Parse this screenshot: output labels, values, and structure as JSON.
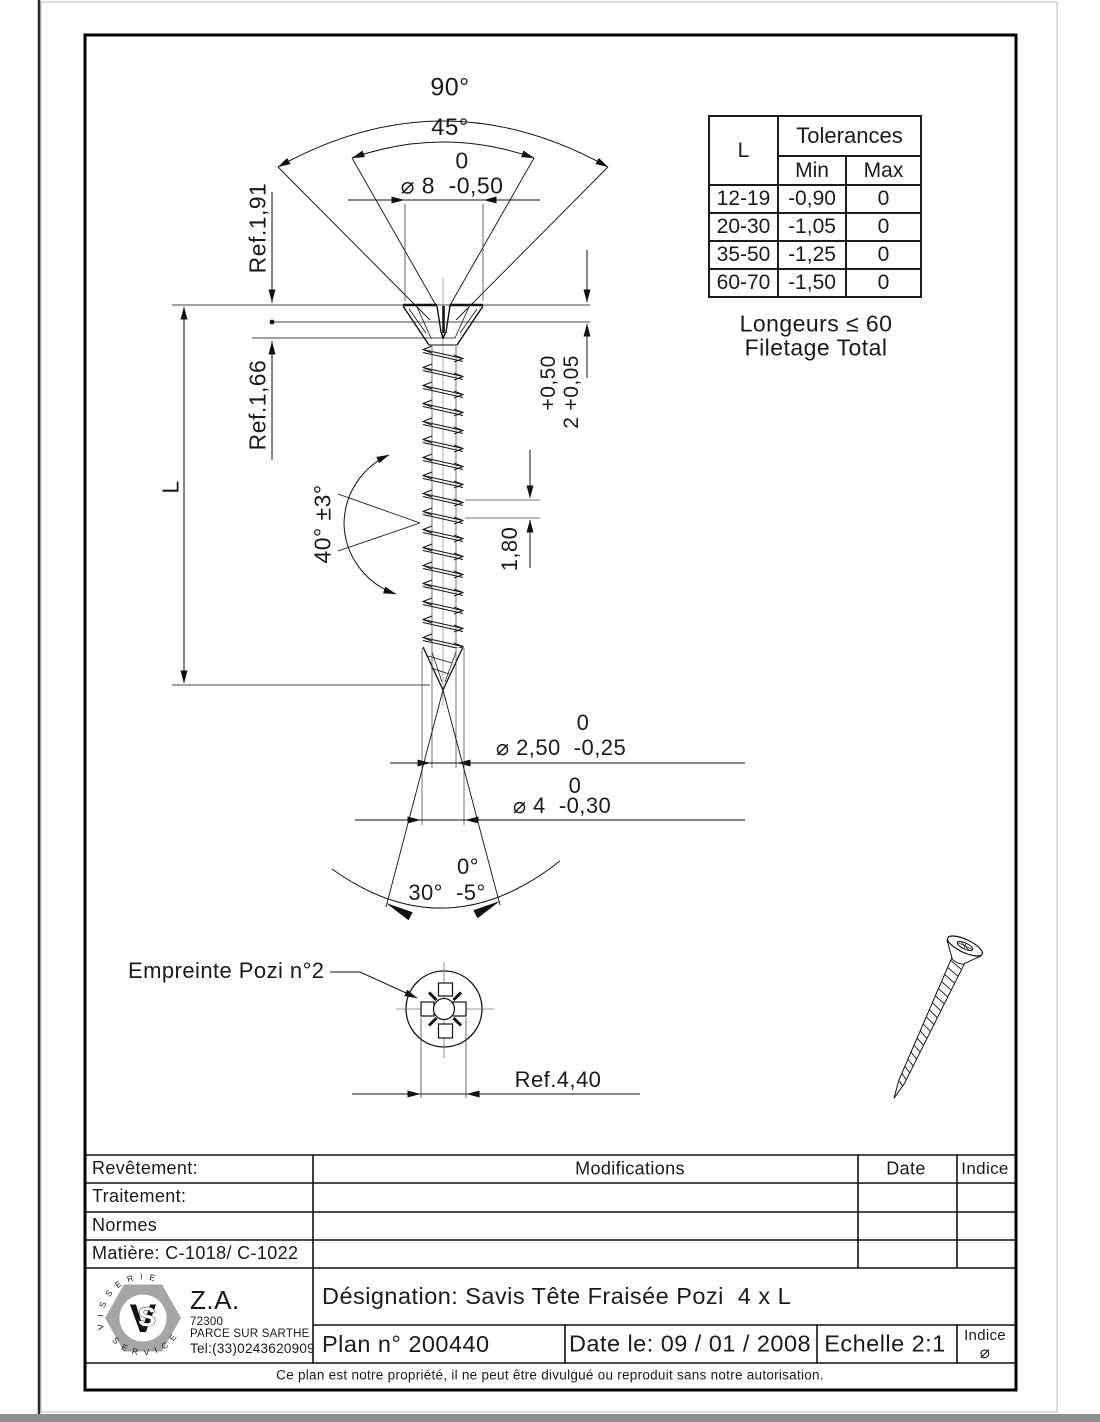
{
  "drawing": {
    "dims": {
      "angle_head_outer": "90°",
      "angle_head_inner": "45°",
      "dia_head_tol": "0",
      "dia_head": "⌀ 8  -0,50",
      "ref_head_1": "Ref.1,91",
      "ref_head_2": "Ref.1,66",
      "length": "L",
      "head_height_tol": "+0,50",
      "head_height": "2 +0,05",
      "thread_angle": "40° ±3°",
      "pitch": "1,80",
      "dia_core_tol": "0",
      "dia_core": "⌀ 2,50  -0,25",
      "dia_thread_tol": "0",
      "dia_thread": "⌀ 4  -0,30",
      "tip_angle_tol": "0°",
      "tip_angle": "30°  -5°",
      "recess_label": "Empreinte Pozi n°2",
      "recess_ref": "Ref.4,40"
    },
    "note_line1": "Longeurs ≤ 60",
    "note_line2": "Filetage Total"
  },
  "tolerances_table": {
    "col_l": "L",
    "title": "Tolerances",
    "min": "Min",
    "max": "Max",
    "rows": [
      {
        "l": "12-19",
        "min": "-0,90",
        "max": "0"
      },
      {
        "l": "20-30",
        "min": "-1,05",
        "max": "0"
      },
      {
        "l": "35-50",
        "min": "-1,25",
        "max": "0"
      },
      {
        "l": "60-70",
        "min": "-1,50",
        "max": "0"
      }
    ]
  },
  "title_block": {
    "left_rows": {
      "revetement": "Revêtement:",
      "traitement": "Traitement:",
      "normes": "Normes",
      "matiere": "Matière: C-1018/ C-1022"
    },
    "modifications": "Modifications",
    "date": "Date",
    "indice": "Indice",
    "company": {
      "za": "Z.A.",
      "zip": "72300",
      "city": "PARCE SUR SARTHE",
      "tel": "Tel:(33)0243620909",
      "logo_top": "V I S S E R I E",
      "logo_bottom": "S E R V I C E",
      "logo_v": "V",
      "logo_s": "S"
    },
    "designation": "Désignation: Savis Tête Fraisée Pozi  4 x L",
    "plan": "Plan n° 200440",
    "date_le": "Date le: 09 / 01 / 2008",
    "echelle": "Echelle 2:1",
    "indice_label": "Indice",
    "indice_value": "⌀",
    "footer": "Ce plan est notre propriété, il ne peut être divulgué ou reproduit sans notre autorisation."
  }
}
